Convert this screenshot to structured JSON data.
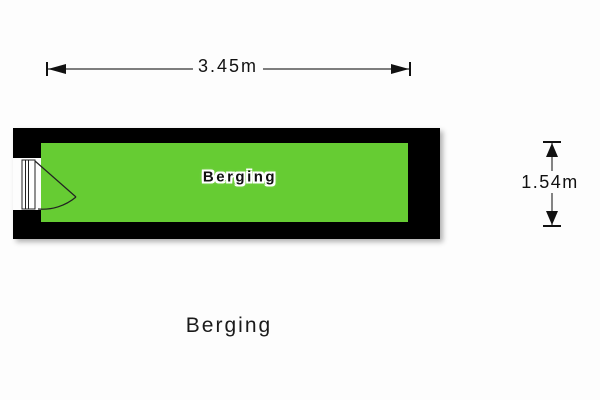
{
  "plan": {
    "title": "Berging",
    "room": {
      "label": "Berging",
      "width_dimension": "3.45m",
      "height_dimension": "1.54m"
    },
    "icons": {
      "door": "door-swing-icon"
    },
    "colors": {
      "floor": "#66cc33",
      "wall": "#000000",
      "background": "#fdfdfd",
      "dimension_line": "#333333",
      "text": "#111111"
    }
  }
}
